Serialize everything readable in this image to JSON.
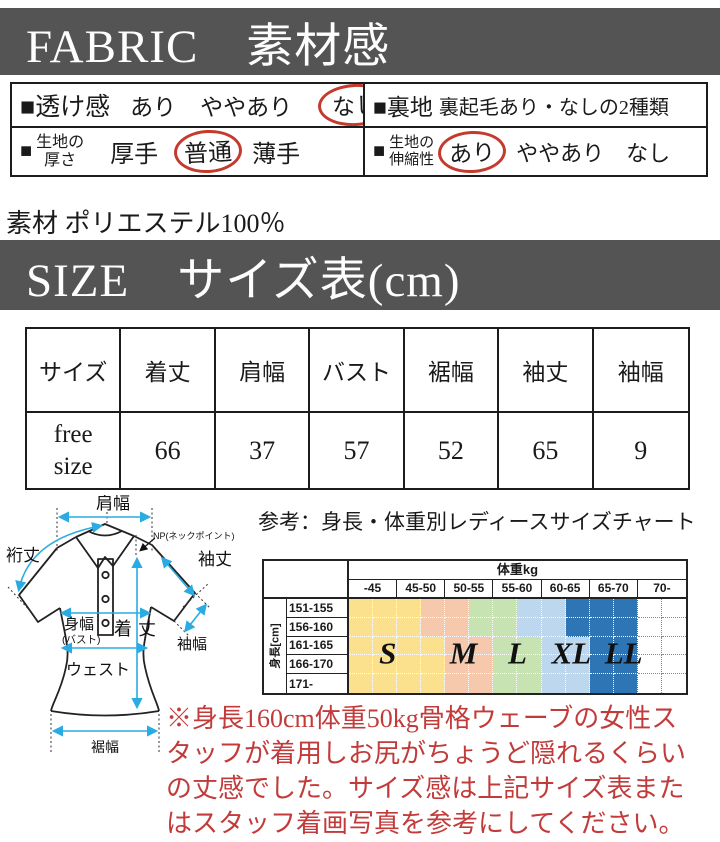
{
  "fabric": {
    "banner_title": "FABRIC　素材感",
    "see_through": {
      "label": "■透け感",
      "options": [
        "あり",
        "ややあり",
        "なし"
      ],
      "circled": "なし"
    },
    "lining": {
      "label": "■裏地",
      "value": "裏起毛あり・なしの2種類"
    },
    "thickness": {
      "bullet": "■",
      "label_line1": "生地の",
      "label_line2": "厚さ",
      "options": [
        "厚手",
        "普通",
        "薄手"
      ],
      "circled": "普通"
    },
    "stretch": {
      "bullet": "■",
      "label_line1": "生地の",
      "label_line2": "伸縮性",
      "options": [
        "あり",
        "ややあり",
        "なし"
      ],
      "circled": "あり"
    },
    "material": "素材 ポリエステル100％"
  },
  "size_section": {
    "banner_title": "SIZE　サイズ表(cm)",
    "table": {
      "headers": [
        "サイズ",
        "着丈",
        "肩幅",
        "バスト",
        "裾幅",
        "袖丈",
        "袖幅"
      ],
      "row_label": "free size",
      "values": [
        "66",
        "37",
        "57",
        "52",
        "65",
        "9"
      ]
    }
  },
  "diagram": {
    "shoulder_width": "肩幅",
    "yuki_length": "裄丈",
    "neck_point": "NP(ネックポイント)",
    "sleeve_length": "袖丈",
    "sleeve_width": "袖幅",
    "body_width": "身幅",
    "body_width_sub": "(バスト)",
    "garment_length": "着丈",
    "waist": "ウェスト",
    "hem_width": "裾幅"
  },
  "reference_chart": {
    "caption": "参考：身長・体重別レディースサイズチャート",
    "weight_header": "体重kg",
    "weight_columns": [
      "-45",
      "45-50",
      "50-55",
      "55-60",
      "60-65",
      "65-70",
      "70-"
    ],
    "height_axis_label": "身長[cm]",
    "height_rows": [
      "151-155",
      "156-160",
      "161-165",
      "166-170",
      "171-"
    ],
    "legend_colors": {
      "S": "#FBE08D",
      "M": "#F6C9AC",
      "L": "#C8E3B2",
      "XL": "#BDD7EE",
      "LL": "#2E75B6",
      "none": "#FFFFFF"
    },
    "cell_map": [
      [
        "S",
        "S",
        "S",
        "M",
        "M",
        "L",
        "L",
        "XL",
        "XL",
        "LL",
        "LL",
        "LL",
        "none",
        "none"
      ],
      [
        "S",
        "S",
        "S",
        "M",
        "M",
        "L",
        "L",
        "XL",
        "XL",
        "LL",
        "LL",
        "LL",
        "none",
        "none"
      ],
      [
        "S",
        "S",
        "S",
        "S",
        "M",
        "M",
        "L",
        "L",
        "XL",
        "XL",
        "LL",
        "LL",
        "none",
        "none"
      ],
      [
        "S",
        "S",
        "S",
        "S",
        "M",
        "M",
        "L",
        "L",
        "XL",
        "XL",
        "LL",
        "LL",
        "none",
        "none"
      ],
      [
        "S",
        "S",
        "S",
        "S",
        "M",
        "M",
        "L",
        "L",
        "XL",
        "XL",
        "LL",
        "LL",
        "none",
        "none"
      ]
    ],
    "size_labels": [
      {
        "text": "S",
        "left_pct": 11.5,
        "top_pct": 58
      },
      {
        "text": "M",
        "left_pct": 34,
        "top_pct": 58
      },
      {
        "text": "L",
        "left_pct": 50,
        "top_pct": 58
      },
      {
        "text": "XL",
        "left_pct": 66,
        "top_pct": 58
      },
      {
        "text": "LL",
        "left_pct": 81.5,
        "top_pct": 58
      }
    ]
  },
  "note": {
    "lines": [
      "※身長160cm体重50kg骨格ウェーブの女性ス",
      "タッフが着用しお尻がちょうど隠れるくらい",
      "の丈感でした。サイズ感は上記サイズ表また",
      "はスタッフ着画写真を参考にしてください。"
    ],
    "color": "#c23b3b"
  },
  "colors": {
    "banner_bg": "#545454",
    "accent_red": "#c43a2c",
    "arrow_cyan": "#2aace2"
  }
}
